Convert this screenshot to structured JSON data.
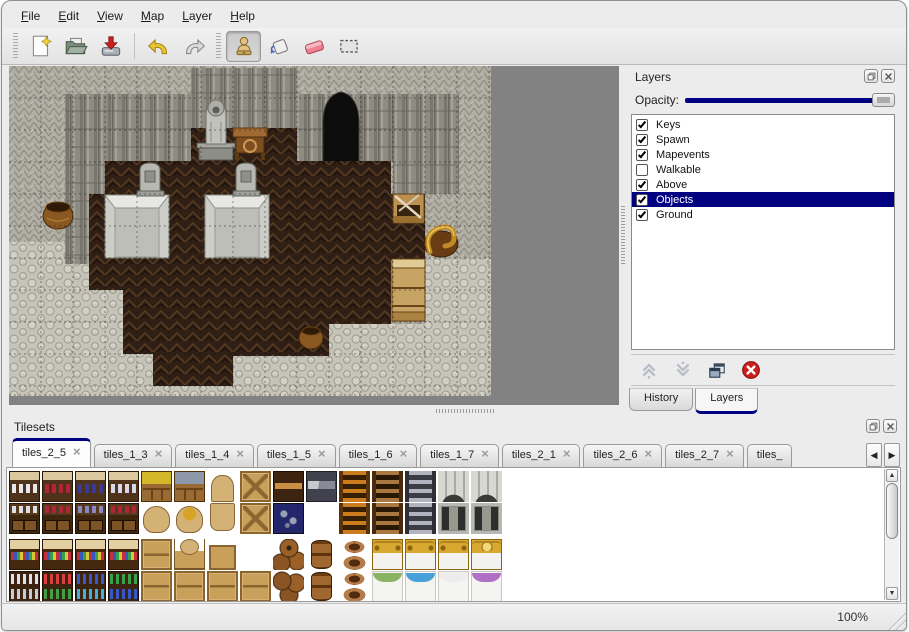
{
  "app": {
    "status_zoom": "100%"
  },
  "colors": {
    "accent": "#000080",
    "selection": "#000080",
    "map_background": "#828282",
    "delete_red": "#cc2020"
  },
  "menu_bar": {
    "items": [
      {
        "label": "File"
      },
      {
        "label": "Edit"
      },
      {
        "label": "View"
      },
      {
        "label": "Map"
      },
      {
        "label": "Layer"
      },
      {
        "label": "Help"
      }
    ]
  },
  "toolbar": {
    "buttons": [
      {
        "name": "new-file"
      },
      {
        "name": "open-file"
      },
      {
        "name": "save-file"
      },
      {
        "name": "undo"
      },
      {
        "name": "redo"
      },
      {
        "name": "stamp-tool",
        "selected": true
      },
      {
        "name": "fill-tool"
      },
      {
        "name": "eraser-tool"
      },
      {
        "name": "rect-select-tool"
      }
    ]
  },
  "layers_panel": {
    "title": "Layers",
    "opacity_label": "Opacity:",
    "opacity_percent": 100,
    "layers": [
      {
        "name": "Keys",
        "checked": true,
        "selected": false
      },
      {
        "name": "Spawn",
        "checked": true,
        "selected": false
      },
      {
        "name": "Mapevents",
        "checked": true,
        "selected": false
      },
      {
        "name": "Walkable",
        "checked": false,
        "selected": false
      },
      {
        "name": "Above",
        "checked": true,
        "selected": false
      },
      {
        "name": "Objects",
        "checked": true,
        "selected": true
      },
      {
        "name": "Ground",
        "checked": true,
        "selected": false
      }
    ],
    "buttons": [
      "move-layer-up",
      "move-layer-down",
      "duplicate-layer",
      "delete-layer"
    ],
    "tabs": [
      {
        "label": "History",
        "active": false
      },
      {
        "label": "Layers",
        "active": true
      }
    ]
  },
  "tilesets_panel": {
    "title": "Tilesets",
    "tabs": [
      {
        "label": "tiles_2_5",
        "active": true
      },
      {
        "label": "tiles_1_3",
        "active": false
      },
      {
        "label": "tiles_1_4",
        "active": false
      },
      {
        "label": "tiles_1_5",
        "active": false
      },
      {
        "label": "tiles_1_6",
        "active": false
      },
      {
        "label": "tiles_1_7",
        "active": false
      },
      {
        "label": "tiles_2_1",
        "active": false
      },
      {
        "label": "tiles_2_6",
        "active": false
      },
      {
        "label": "tiles_2_7",
        "active": false
      },
      {
        "label": "tiles_",
        "active": false,
        "partial": true
      }
    ],
    "tile_grid": [
      [
        "sh-w",
        "sh-r",
        "sh-b",
        "sh-j",
        "pl-y",
        "pl-b",
        "sck-t",
        "crx",
        "chd",
        "chg",
        "lad-o",
        "lad-b",
        "lad-g",
        "arch",
        "arch",
        ""
      ],
      [
        "shb-w",
        "shb-r",
        "shb-b",
        "shb-r2",
        "sck",
        "sck-o",
        "sck-b",
        "crx",
        "ore",
        "",
        "lad-o",
        "lad-b",
        "lad-g",
        "door",
        "door",
        ""
      ],
      [
        "s2",
        "s2",
        "s2",
        "s2",
        "crate",
        "sck-c",
        "crate-s",
        "",
        "brl-p",
        "brl-u",
        "pot-t",
        "bed-h",
        "bed-h",
        "bed-h",
        "bed-hp",
        ""
      ],
      [
        "s2b-j",
        "s2b-m",
        "s2b-b",
        "s2b-g",
        "crate",
        "crate",
        "crate",
        "crate",
        "brl-p2",
        "brl-u",
        "pot-b",
        "bd-g",
        "bd-b",
        "bd-w",
        "bd-p",
        ""
      ]
    ]
  },
  "map_view": {
    "objects": [
      "cave-entrance",
      "statue",
      "table",
      "gravestone",
      "gravestone",
      "platform",
      "platform",
      "pot",
      "pot",
      "broken-crate",
      "golden-horn",
      "wooden-shelf"
    ]
  }
}
